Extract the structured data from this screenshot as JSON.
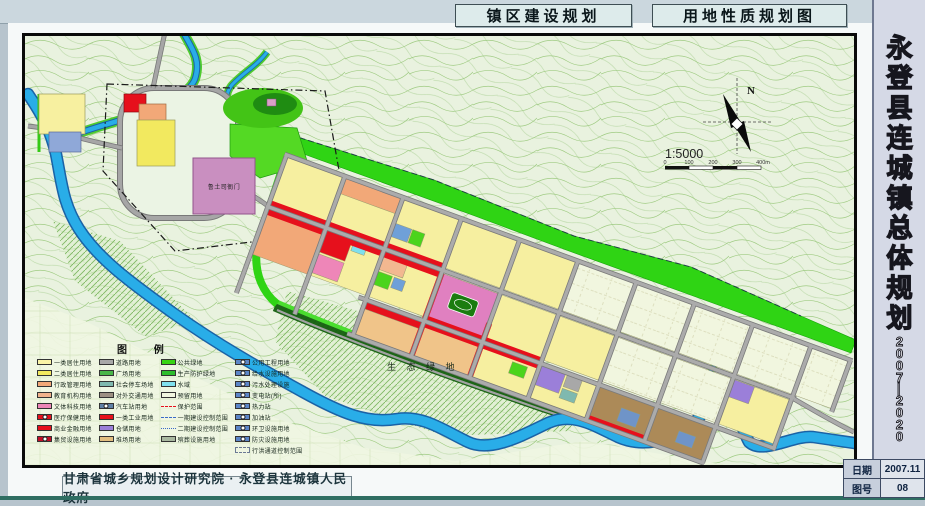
{
  "header": {
    "left_title": "镇区建设规划",
    "right_title": "用地性质规划图"
  },
  "sidebar": {
    "title": "永登县连城镇总体规划",
    "period": "2007—2020",
    "period_chars": [
      "2",
      "0",
      "0",
      "7",
      "—",
      "2",
      "0",
      "2",
      "0"
    ],
    "date_label": "日期",
    "date_value": "2007.11",
    "sheet_label": "图号",
    "sheet_value": "08"
  },
  "footer": {
    "organization": "甘肃省城乡规划设计研究院 · 永登县连城镇人民政府"
  },
  "map": {
    "compass_label": "N",
    "scale_text": "1:5000",
    "scale_ticks": [
      "0",
      "100",
      "200",
      "300",
      "400m"
    ],
    "labels": {
      "eco_area": "生 态 绿 地",
      "heritage": "鲁土司衙门"
    },
    "colors": {
      "river": "#29ADE8",
      "river_edge": "#1A62A6",
      "green_belt": "#2FD414",
      "road": "#ABABAB",
      "residential": "#F6EFA0",
      "commercial_red": "#E6101C"
    },
    "legend": {
      "title": "图    例",
      "columns": [
        [
          {
            "label": "一类居住用地",
            "color": "#F9F3A6"
          },
          {
            "label": "二类居住用地",
            "color": "#F2E95F"
          },
          {
            "label": "行政管理用地",
            "color": "#F2A878"
          },
          {
            "label": "教育机构用地",
            "color": "#F0B28C"
          },
          {
            "label": "文体科技用地",
            "color": "#EE86B8"
          },
          {
            "label": "医疗保健用地",
            "color": "#E6101C",
            "dot": true
          },
          {
            "label": "商业金融用地",
            "color": "#E6101C"
          },
          {
            "label": "集贸设施用地",
            "color": "#C40E28",
            "dot": true
          }
        ],
        [
          {
            "label": "道路用地",
            "color": "#A8A8A8"
          },
          {
            "label": "广场用地",
            "color": "#49B649"
          },
          {
            "label": "社会停车场地",
            "color": "#7FB9AF"
          },
          {
            "label": "对外交通用地",
            "color": "#9D9083"
          },
          {
            "label": "汽车站用地",
            "color": "#5F80A6",
            "dot": true
          },
          {
            "label": "一类工业用地",
            "color": "#E6101C"
          },
          {
            "label": "仓储用地",
            "color": "#9B7FD9"
          },
          {
            "label": "堆场用地",
            "color": "#E2BE80"
          }
        ],
        [
          {
            "label": "公共绿地",
            "color": "#37D414"
          },
          {
            "label": "生产防护绿地",
            "color": "#2DBD2D"
          },
          {
            "label": "水域",
            "color": "#7FE0EE"
          },
          {
            "label": "预留用地",
            "color": "#F1F6DF"
          },
          {
            "label": "保护范围",
            "style": "dash",
            "color": "#E6101C"
          },
          {
            "label": "一期建设控制范围",
            "style": "dash",
            "color": "#3A6AC8"
          },
          {
            "label": "二期建设控制范围",
            "style": "dash2",
            "color": "#3A6AC8"
          },
          {
            "label": "殡葬设施用地",
            "color": "#A9B8A0"
          }
        ],
        [
          {
            "label": "公用工程用地",
            "color": "#5C86C8",
            "dot": true
          },
          {
            "label": "给水设施用地",
            "color": "#5C86C8",
            "dot": true
          },
          {
            "label": "污水处理设施",
            "color": "#5C86C8",
            "dot": true
          },
          {
            "label": "变电站(所)",
            "color": "#5C86C8",
            "dot": true
          },
          {
            "label": "热力站",
            "color": "#5C86C8",
            "dot": true
          },
          {
            "label": "加油站",
            "color": "#5C86C8",
            "dot": true
          },
          {
            "label": "环卫设施用地",
            "color": "#5C86C8",
            "dot": true
          },
          {
            "label": "防灾设施用地",
            "color": "#5C86C8",
            "dot": true
          },
          {
            "label": "行洪通道控制范围",
            "style": "dashbox",
            "color": "#6B7A94"
          }
        ]
      ]
    }
  }
}
